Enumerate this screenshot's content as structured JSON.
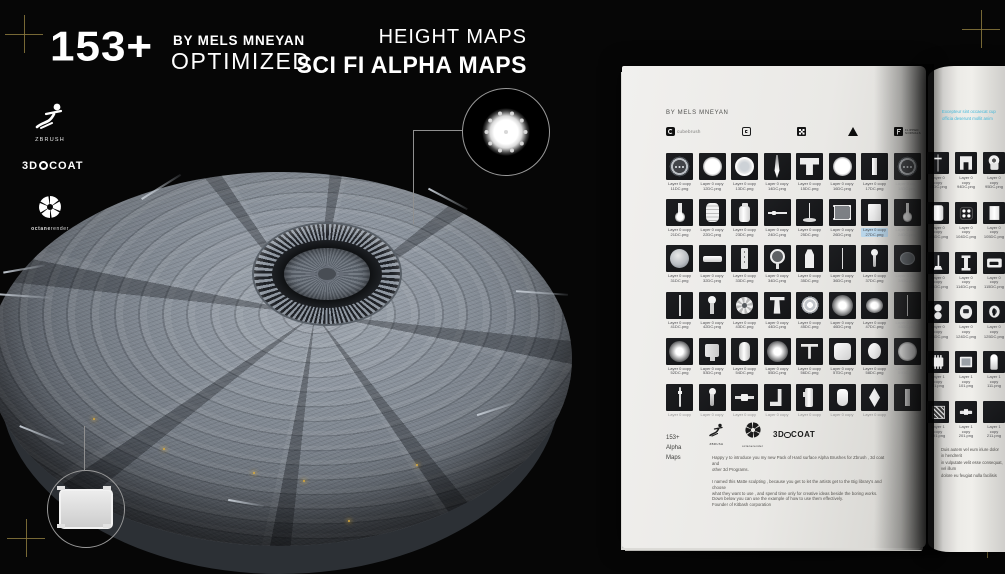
{
  "header": {
    "count": "153+",
    "byline": "BY MELS MNEYAN",
    "optimized": "OPTIMIZED",
    "subtitle": "HEIGHT MAPS",
    "title": "SCI FI ALPHA MAPS"
  },
  "software": {
    "zbrush_label": "ZBRUSH",
    "coat_pre": "3D",
    "coat_post": "COAT",
    "octane_bold": "octane",
    "octane_light": "render"
  },
  "colors": {
    "background": "#060606",
    "registration_mark": "#8c7a3e",
    "page": "#ecebe7",
    "highlight": "#b9d6ea",
    "cyan_text": "#3fb7da",
    "glint": "#d8aa3e"
  },
  "book": {
    "left": {
      "byline": "BY MELS MNEYAN",
      "stores": [
        {
          "id": "cubebrush",
          "label": "cubebrush"
        },
        {
          "id": "gumroad",
          "label": ""
        },
        {
          "id": "dotgrid",
          "label": ""
        },
        {
          "id": "artstation",
          "label": ""
        },
        {
          "id": "flippednormals",
          "label": "FLIPPED NORMALS"
        }
      ],
      "label_top": "Layer 0 copy",
      "rows": [
        [
          {
            "f": "11DC.png",
            "s": "btn3"
          },
          {
            "f": "12DC.png",
            "s": "disc"
          },
          {
            "f": "13DC.png",
            "s": "ring"
          },
          {
            "f": "14DC.png",
            "s": "spike"
          },
          {
            "f": "15DC.png",
            "s": "tpipe"
          },
          {
            "f": "16DC.png",
            "s": "disc"
          },
          {
            "f": "17DC.png",
            "s": "vbar"
          },
          {
            "f": "18DC.png",
            "s": "btn3",
            "dim": true
          }
        ],
        [
          {
            "f": "21DC.png",
            "s": "bulb"
          },
          {
            "f": "22DC.png",
            "s": "barrel"
          },
          {
            "f": "23DC.png",
            "s": "canister"
          },
          {
            "f": "24DC.png",
            "s": "hline"
          },
          {
            "f": "25DC.png",
            "s": "stand"
          },
          {
            "f": "26DC.png",
            "s": "panelb"
          },
          {
            "f": "27DC.png",
            "s": "rectp",
            "hl": true
          },
          {
            "f": "28DC.png",
            "s": "bulb",
            "dim": true
          }
        ],
        [
          {
            "f": "31DC.png",
            "s": "sphere"
          },
          {
            "f": "32DC.png",
            "s": "hbar"
          },
          {
            "f": "33DC.png",
            "s": "strip"
          },
          {
            "f": "34DC.png",
            "s": "keyc"
          },
          {
            "f": "35DC.png",
            "s": "bottle"
          },
          {
            "f": "36DC.png",
            "s": "thinv"
          },
          {
            "f": "37DC.png",
            "s": "pin"
          },
          {
            "f": "38DC.png",
            "s": "ovald",
            "dim": true
          }
        ],
        [
          {
            "f": "41DC.png",
            "s": "thinv"
          },
          {
            "f": "42DC.png",
            "s": "pin2"
          },
          {
            "f": "43DC.png",
            "s": "gear"
          },
          {
            "f": "44DC.png",
            "s": "tbolt"
          },
          {
            "f": "45DC.png",
            "s": "cone"
          },
          {
            "f": "46DC.png",
            "s": "glow"
          },
          {
            "f": "47DC.png",
            "s": "glowo"
          },
          {
            "f": "48DC.png",
            "s": "thinv",
            "dim": true
          }
        ],
        [
          {
            "f": "52DC.png",
            "s": "glow"
          },
          {
            "f": "53DC.png",
            "s": "device"
          },
          {
            "f": "54DC.png",
            "s": "cylr"
          },
          {
            "f": "55DC.png",
            "s": "glow"
          },
          {
            "f": "56DC.png",
            "s": "tshape"
          },
          {
            "f": "57DC.png",
            "s": "sqr"
          },
          {
            "f": "58DC.png",
            "s": "oval"
          },
          {
            "f": "59DC.png",
            "s": "disc",
            "dim": true
          }
        ],
        [
          {
            "f": "",
            "s": "rod",
            "cut": true
          },
          {
            "f": "",
            "s": "pin",
            "cut": true
          },
          {
            "f": "",
            "s": "sbar2",
            "cut": true
          },
          {
            "f": "",
            "s": "corner",
            "cut": true
          },
          {
            "f": "",
            "s": "cyld",
            "cut": true
          },
          {
            "f": "",
            "s": "bottler",
            "cut": true
          },
          {
            "f": "",
            "s": "diamond",
            "cut": true
          },
          {
            "f": "",
            "s": "vbar",
            "cut": true,
            "dim": true
          }
        ]
      ],
      "footer": {
        "count": "153+",
        "alpha": "Alpha",
        "maps": "Maps"
      },
      "mini_logos": {
        "zbrush": "ZBRUSH",
        "octane": "octanerender",
        "coat_pre": "3D",
        "coat_post": "COAT"
      },
      "paragraphs": [
        [
          "Happy y to introduce  you my new Pack of Hard surface Alpha  Brushes for Zbrush , 3d coat and",
          "other 3d Programs."
        ],
        [
          "I named this Matte sculpting , because  you get to let the artists get to the Big library's  and choose",
          "what they want to use , and spend time only for creative ideas beside the boring works.",
          "Down below you can use the example of how to use them effectively.",
          "Founder of Kitbash corporation"
        ]
      ]
    },
    "right": {
      "intro": [
        "Excepteur sint occaecat cup",
        "officia deserunt mollit anim"
      ],
      "rows": [
        {
          "t": "Layer 0 copy",
          "cells": [
            {
              "f": "93DC.png",
              "s": "dagger"
            },
            {
              "f": "94DC.png",
              "s": "bracket"
            },
            {
              "f": "95DC.png",
              "s": "keyhole2"
            }
          ]
        },
        {
          "t": "Layer 0 copy",
          "cells": [
            {
              "f": "103DC.png",
              "s": "cylw"
            },
            {
              "f": "104DC.png",
              "s": "btn4"
            },
            {
              "f": "105DC.png",
              "s": "rectw"
            }
          ]
        },
        {
          "t": "Layer 0 copy",
          "cells": [
            {
              "f": "113DC.png",
              "s": "pedestal"
            },
            {
              "f": "114DC.png",
              "s": "ibeam"
            },
            {
              "f": "115DC.png",
              "s": "slot"
            }
          ]
        },
        {
          "t": "Layer 0 copy",
          "cells": [
            {
              "f": "123DC.png",
              "s": "dbl"
            },
            {
              "f": "124DC.png",
              "s": "screen"
            },
            {
              "f": "125DC.png",
              "s": "keyhole"
            }
          ]
        },
        {
          "t": "Layer 1 copy",
          "cells": [
            {
              "f": "91.png",
              "s": "chip"
            },
            {
              "f": "101.png",
              "s": "frame"
            },
            {
              "f": "111.png",
              "s": "dome"
            }
          ]
        },
        {
          "t": "Layer 1 copy",
          "cells": [
            {
              "f": "191.png",
              "s": "hatch"
            },
            {
              "f": "201.png",
              "s": "sbar"
            },
            {
              "f": "211.png",
              "s": "panelr"
            }
          ]
        }
      ],
      "footer_lines": [
        "Duis autem vel eum iriure dolor in hendrerit",
        "in vulputate velit esse consequat, vel illum",
        "dolore eu feugiat nulla facilisis"
      ]
    }
  }
}
